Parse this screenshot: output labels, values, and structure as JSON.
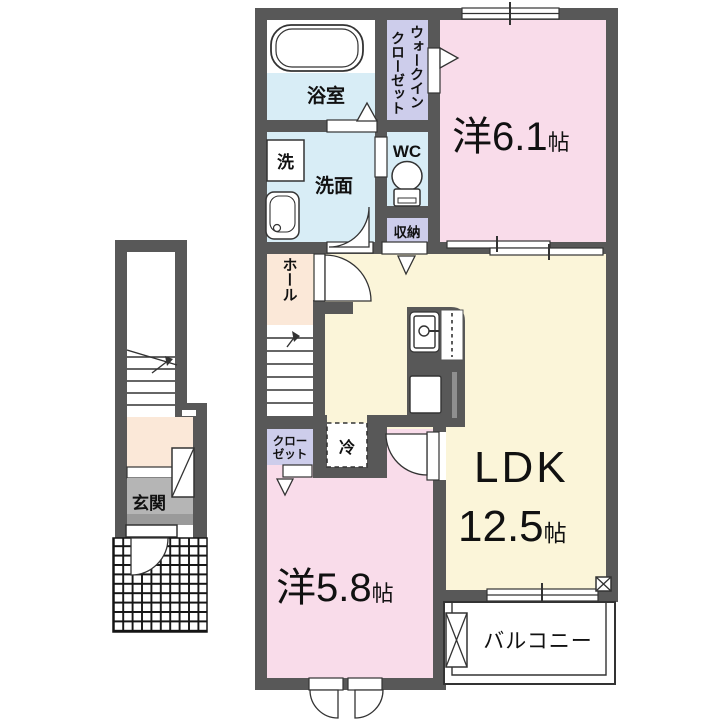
{
  "title": "2F apartment floor plan",
  "colors": {
    "wall": "#585858",
    "room_pink": "#f9dcea",
    "room_cream": "#fbf5d9",
    "room_blue": "#d8edf6",
    "room_lavender": "#cdcdeb",
    "room_peach": "#fbe8d8",
    "entrance_gray": "#b5b5b5",
    "entrance_gray_dark": "#9a9a9a"
  },
  "rooms": {
    "bathroom": "浴室",
    "washer": "洗",
    "washroom": "洗面",
    "wic": [
      "ウォークイン",
      "クローゼット"
    ],
    "wc": "WC",
    "storage": "収納",
    "bedroom1": {
      "prefix": "洋",
      "size": "6.1",
      "unit": "帖"
    },
    "hall": "ホール",
    "ldk": {
      "name": "LDK",
      "size": "12.5",
      "unit": "帖"
    },
    "closet": [
      "クロー",
      "ゼット"
    ],
    "fridge": "冷",
    "bedroom2": {
      "prefix": "洋",
      "size": "5.8",
      "unit": "帖"
    },
    "balcony": "バルコニー",
    "entrance": "玄関"
  }
}
